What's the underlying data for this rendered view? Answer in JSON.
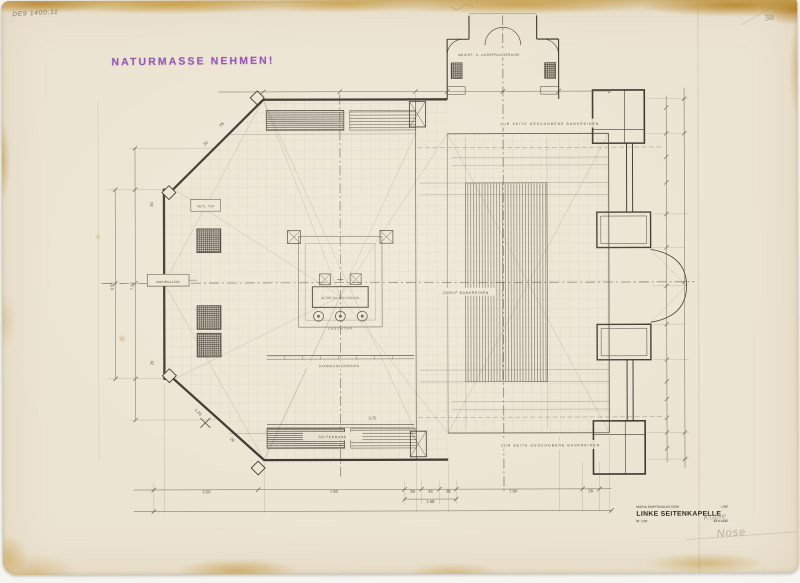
{
  "annotations": {
    "stamp": "NATURMASSE NEHMEN!",
    "corner_note": "DE9 1400.11",
    "corner_mark": "3a",
    "pencil_note_1": "Kopie",
    "pencil_note_2": "Nose"
  },
  "title_block": {
    "project_left": "MARIA EMPFÄNGNIS DOM",
    "project_right": "LINZ",
    "title": "LINKE SEITENKAPELLE",
    "scale": "M. 1:20",
    "date": "23.6.1935"
  },
  "plan_labels": {
    "beicht_raum": "BEICHT- U. AUSSPRACHERAUM",
    "benches_top": "ZUR SEITE GESCHOBENE BANKREIHEN",
    "benches_bottom": "ZUR SEITE GESCHOBENE BANKREIHEN",
    "bench_rows": "ZWÖLF BANKREIHEN",
    "altar": "ALTAR CA.180×100×100",
    "leuchter": "LEUCHTER",
    "kommunionbank": "KOMMUNIONBANK",
    "seitenbank": "SEITENBANK",
    "marienaltar": "MARIENALTAR",
    "niche": "SEITL. TÜR"
  },
  "dimensions": [
    {
      "t": "2.56",
      "x": 205,
      "y": 500.5,
      "r": 0
    },
    {
      "t": "7.90",
      "x": 333,
      "y": 500.5,
      "r": 0
    },
    {
      "t": "28",
      "x": 412,
      "y": 500.5,
      "r": 0
    },
    {
      "t": "43",
      "x": 430,
      "y": 500.5,
      "r": 0
    },
    {
      "t": "28",
      "x": 448,
      "y": 500.5,
      "r": 0
    },
    {
      "t": "7.90",
      "x": 513,
      "y": 500.5,
      "r": 0
    },
    {
      "t": "28",
      "x": 591,
      "y": 500.5,
      "r": 0
    },
    {
      "t": "1.68",
      "x": 430,
      "y": 510.8,
      "r": 0
    },
    {
      "t": "6.56",
      "x": 112,
      "y": 290,
      "r": -90
    },
    {
      "t": "7.30",
      "x": 132,
      "y": 290,
      "r": -90
    },
    {
      "t": "28",
      "x": 222,
      "y": 127,
      "r": -45
    },
    {
      "t": "30",
      "x": 206,
      "y": 146,
      "r": -45
    },
    {
      "t": "30",
      "x": 152,
      "y": 207,
      "r": -90
    },
    {
      "t": "28",
      "x": 152,
      "y": 368,
      "r": -90
    },
    {
      "t": "1.33",
      "x": 196,
      "y": 419,
      "r": 45
    },
    {
      "t": "28",
      "x": 230,
      "y": 447,
      "r": 45
    },
    {
      "t": "3.75",
      "x": 372,
      "y": 426,
      "r": 0
    }
  ]
}
